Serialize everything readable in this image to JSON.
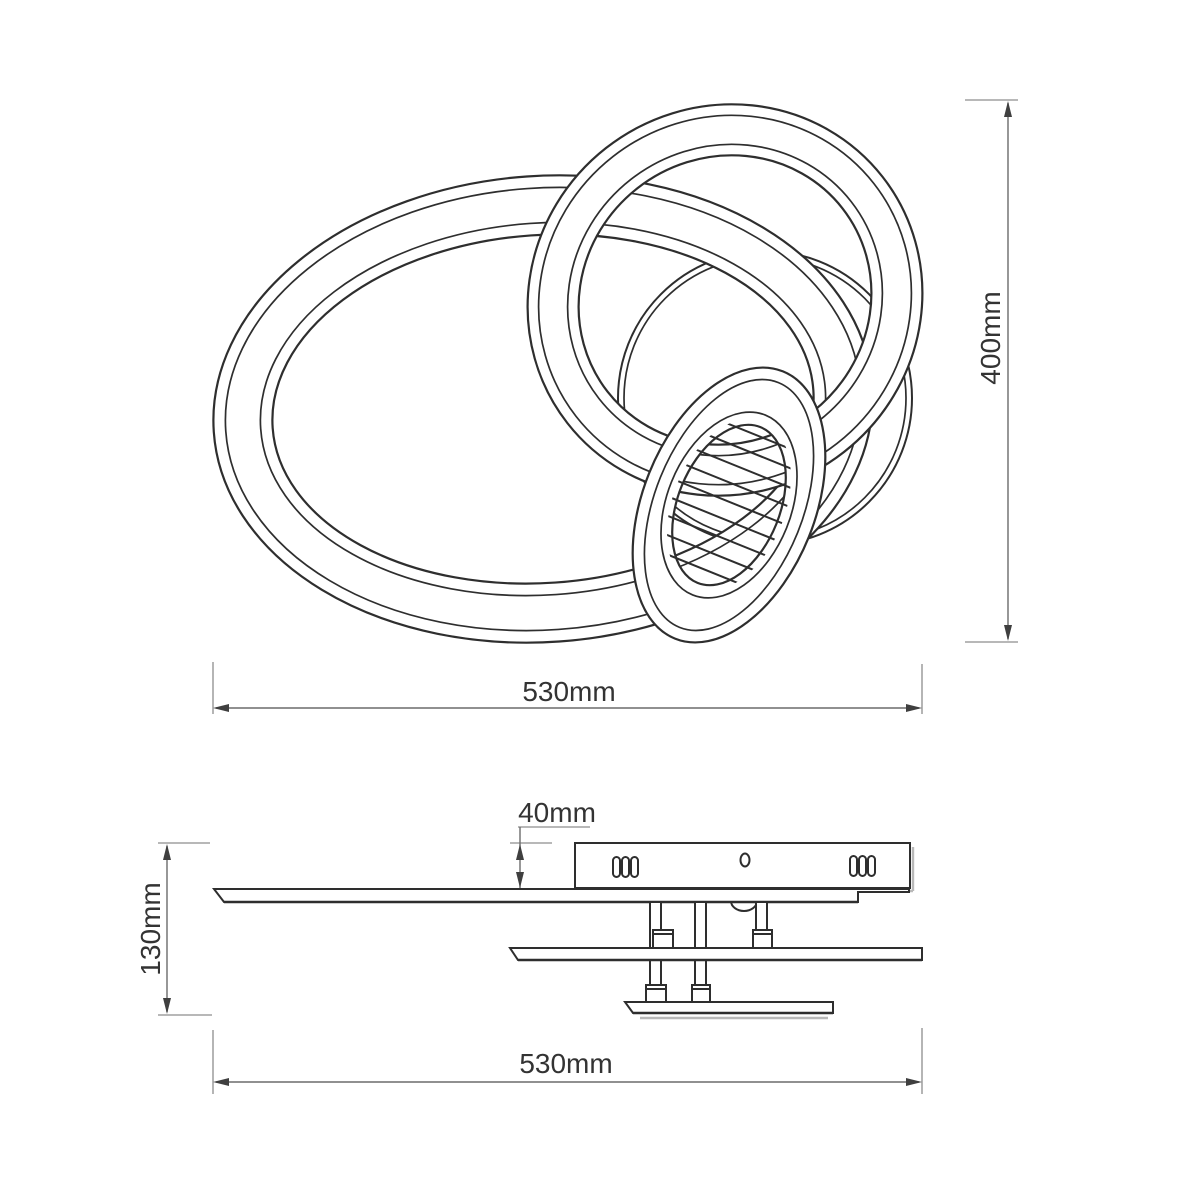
{
  "drawing": {
    "type": "technical-dimension-drawing",
    "product": "ceiling light with three interlocking rings",
    "colors": {
      "background": "#ffffff",
      "line": "#2e2e2e",
      "dimension_line": "#6b6b6b",
      "extension_line": "#8d8d8d",
      "text": "#333333",
      "shadow": "#b9b9b9"
    },
    "top_view": {
      "width_label": "530mm",
      "height_label": "400mm"
    },
    "side_view": {
      "width_label": "530mm",
      "height_label": "130mm",
      "canopy_height_label": "40mm"
    }
  }
}
